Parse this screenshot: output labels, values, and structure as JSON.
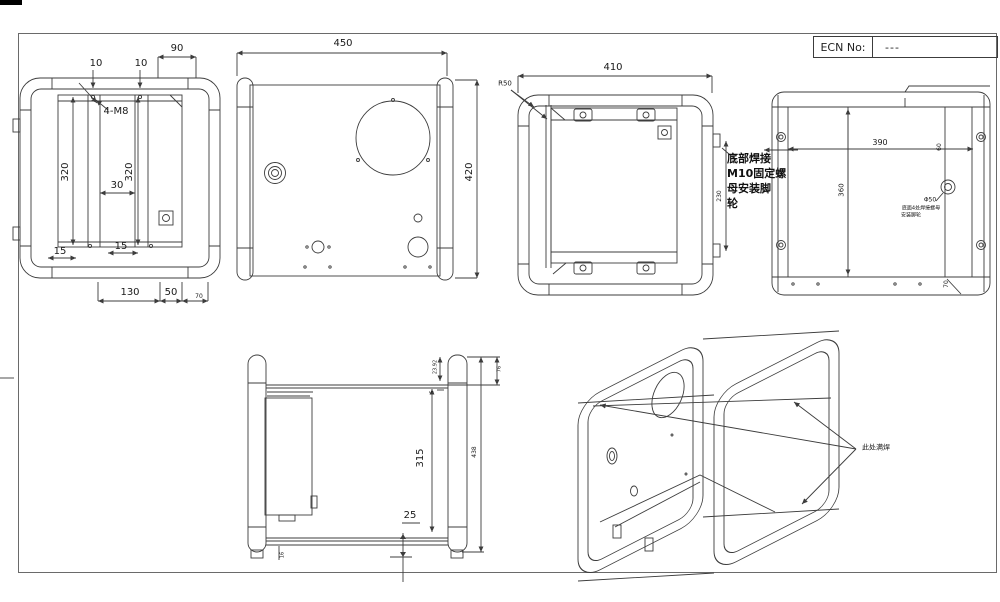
{
  "title_block": {
    "label": "ECN No:",
    "value": "---"
  },
  "views": {
    "front": {
      "dims": {
        "w90": "90",
        "t10a": "10",
        "t10b": "10",
        "thread": "4-M8",
        "h320a": "320",
        "h320b": "320",
        "w30": "30",
        "b15a": "15",
        "b15b": "15",
        "b130": "130",
        "b50": "50",
        "b70": "70"
      }
    },
    "panel": {
      "dims": {
        "w450": "450",
        "h420": "420"
      }
    },
    "door": {
      "dims": {
        "w410": "410",
        "r50": "R50",
        "h230": "230"
      },
      "note_lines": [
        "底部焊接",
        "M10固定螺",
        "母安装脚",
        "轮"
      ]
    },
    "back": {
      "dims": {
        "w390": "390",
        "h360": "360",
        "s60": "60",
        "s70": "70"
      },
      "hole_note": {
        "line1": "Φ50",
        "line2": "底面4处焊接螺母",
        "line3": "安装脚轮"
      }
    },
    "side": {
      "dims": {
        "h315": "315",
        "b25": "25",
        "h438": "438",
        "t2392": "23.92",
        "t76": "76",
        "t5": "5",
        "f16": "16"
      }
    },
    "iso": {
      "note": "此处满焊"
    }
  }
}
